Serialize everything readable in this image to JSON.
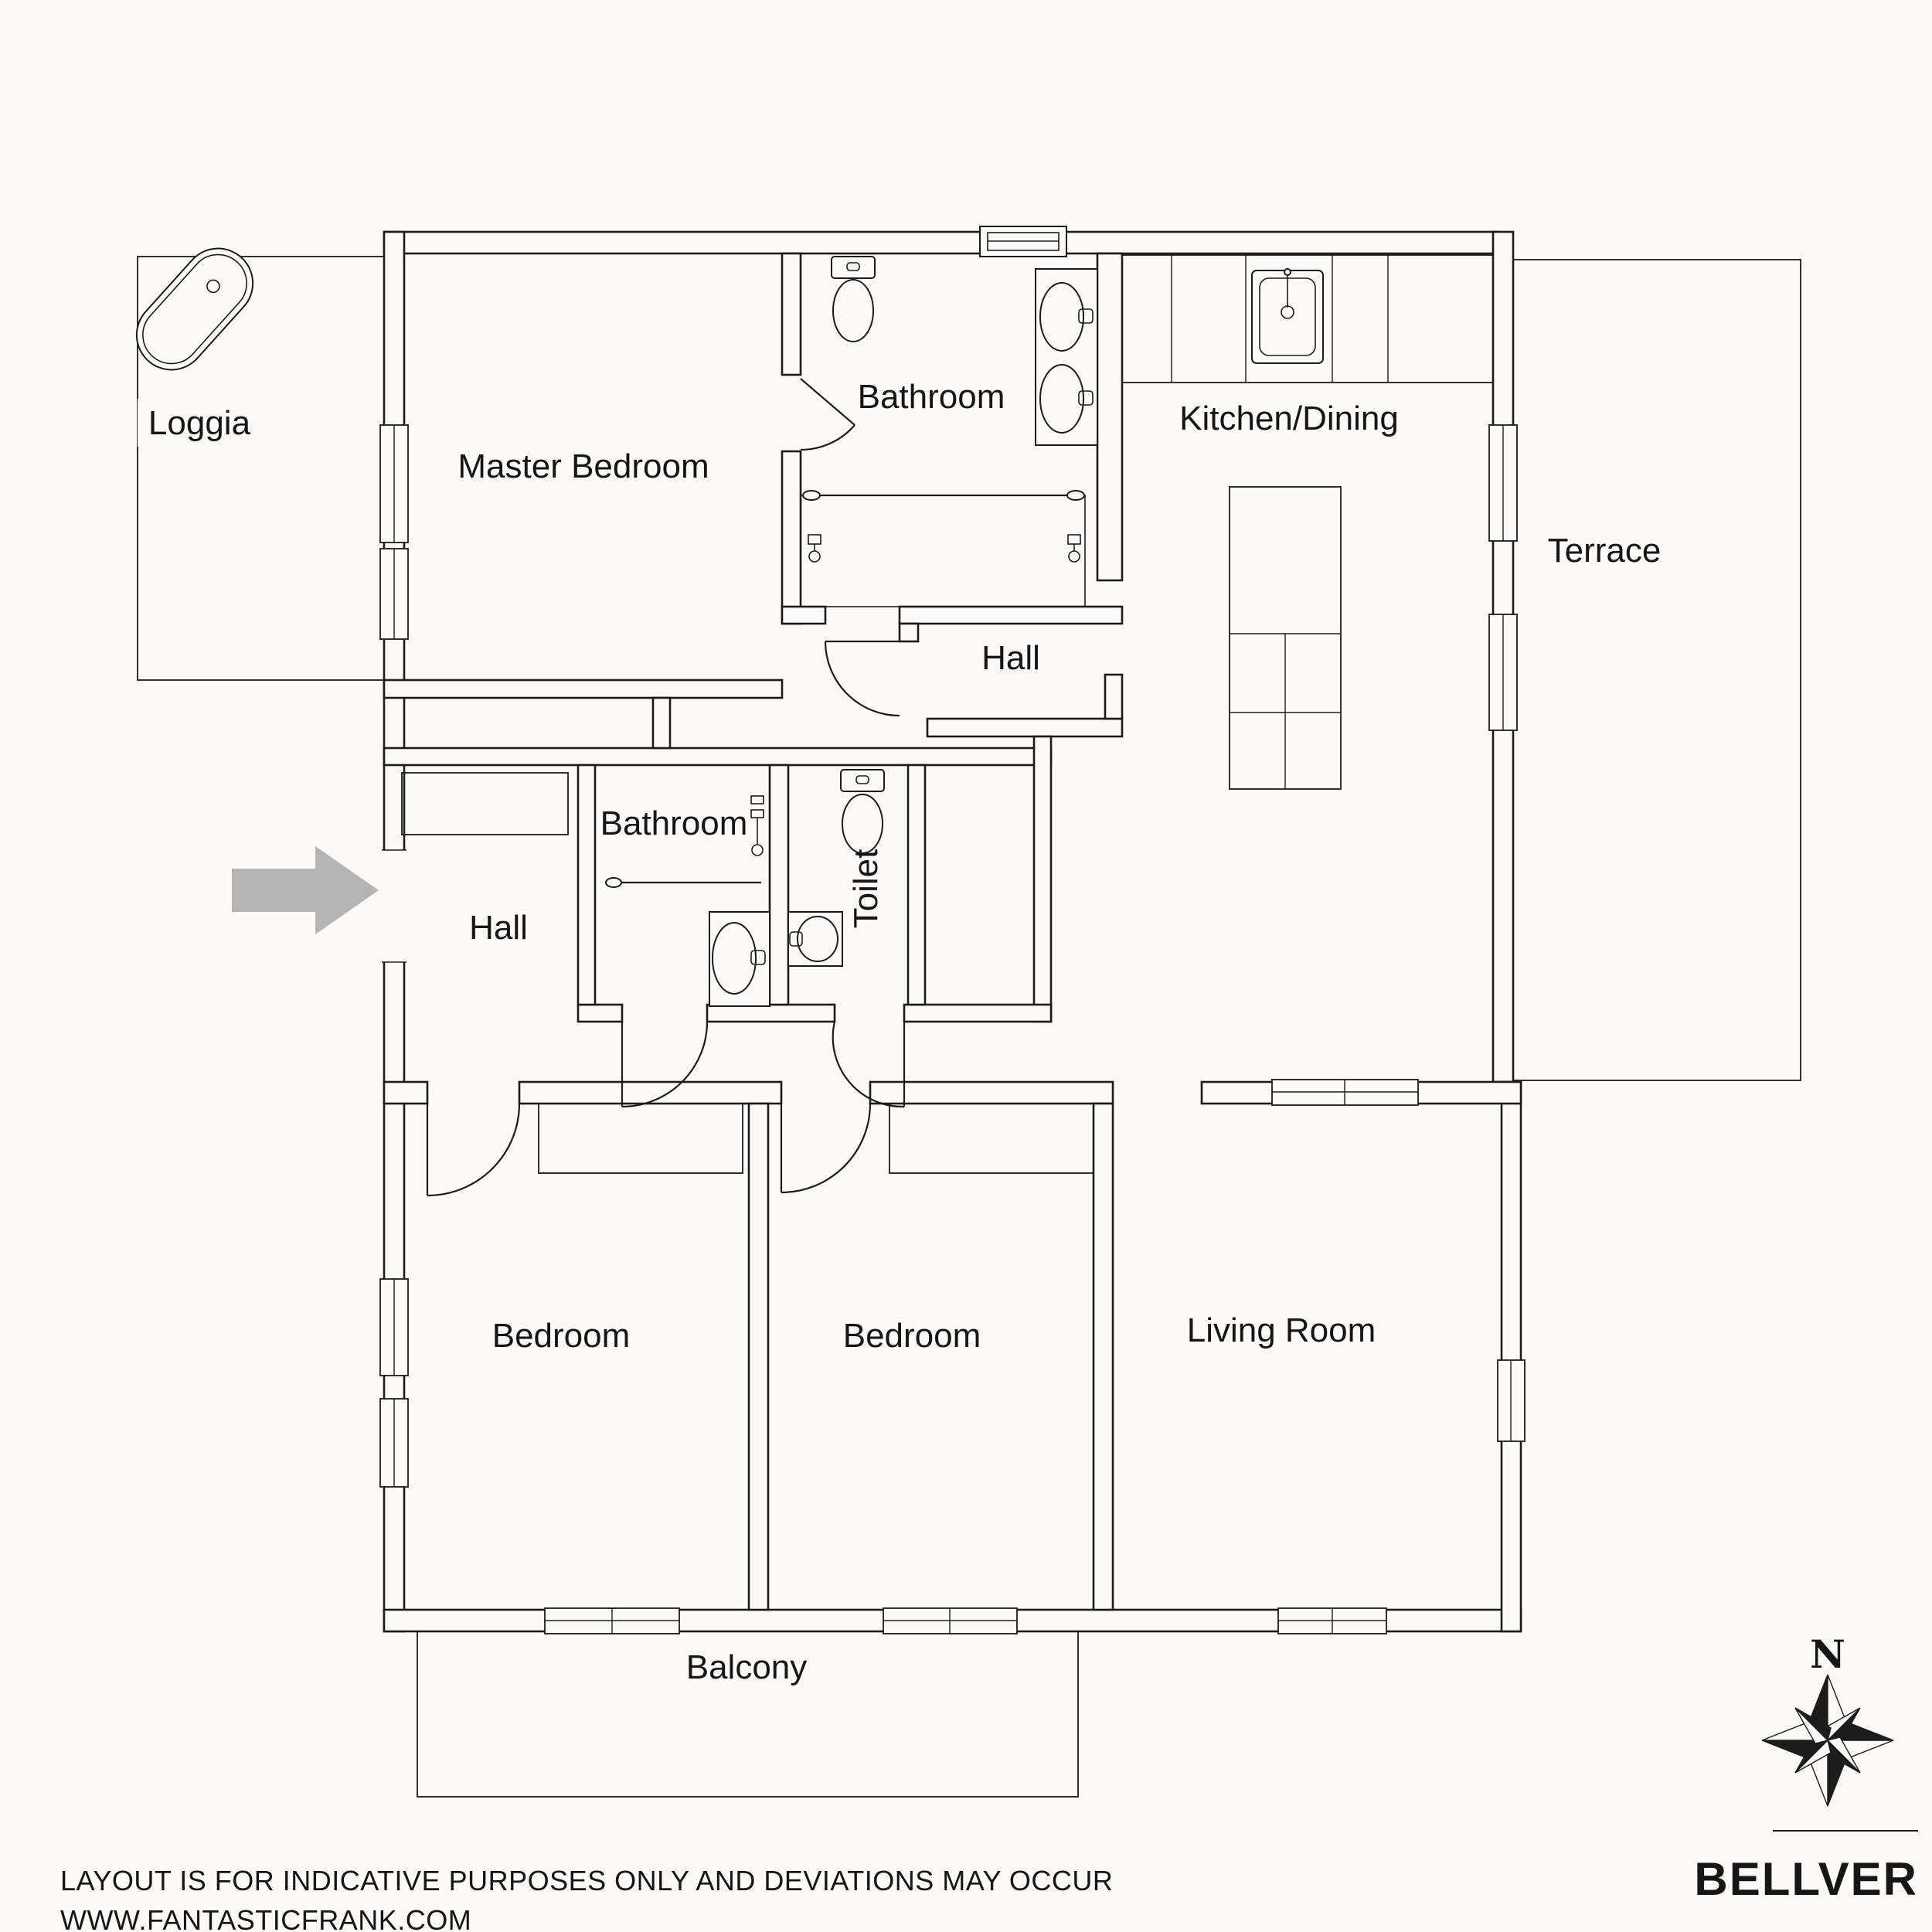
{
  "rooms": {
    "loggia": {
      "label": "Loggia"
    },
    "master_bedroom": {
      "label": "Master Bedroom"
    },
    "bathroom_top": {
      "label": "Bathroom"
    },
    "kitchen_dining": {
      "label": "Kitchen/Dining"
    },
    "terrace": {
      "label": "Terrace"
    },
    "hall_upper": {
      "label": "Hall"
    },
    "bathroom_mid": {
      "label": "Bathroom"
    },
    "toilet": {
      "label": "Toilet"
    },
    "hall_entry": {
      "label": "Hall"
    },
    "bedroom_left": {
      "label": "Bedroom"
    },
    "bedroom_mid": {
      "label": "Bedroom"
    },
    "living_room": {
      "label": "Living Room"
    },
    "balcony": {
      "label": "Balcony"
    }
  },
  "compass": {
    "north_label": "N"
  },
  "footer": {
    "line1": "LAYOUT IS FOR INDICATIVE PURPOSES ONLY AND DEVIATIONS MAY OCCUR",
    "line2": "WWW.FANTASTICFRANK.COM"
  },
  "brand": {
    "name": "BELLVER"
  },
  "colors": {
    "background": "#FBFAF8",
    "line": "#1C1C1C",
    "arrow": "#B4B4B4",
    "hatch": "#474747"
  }
}
